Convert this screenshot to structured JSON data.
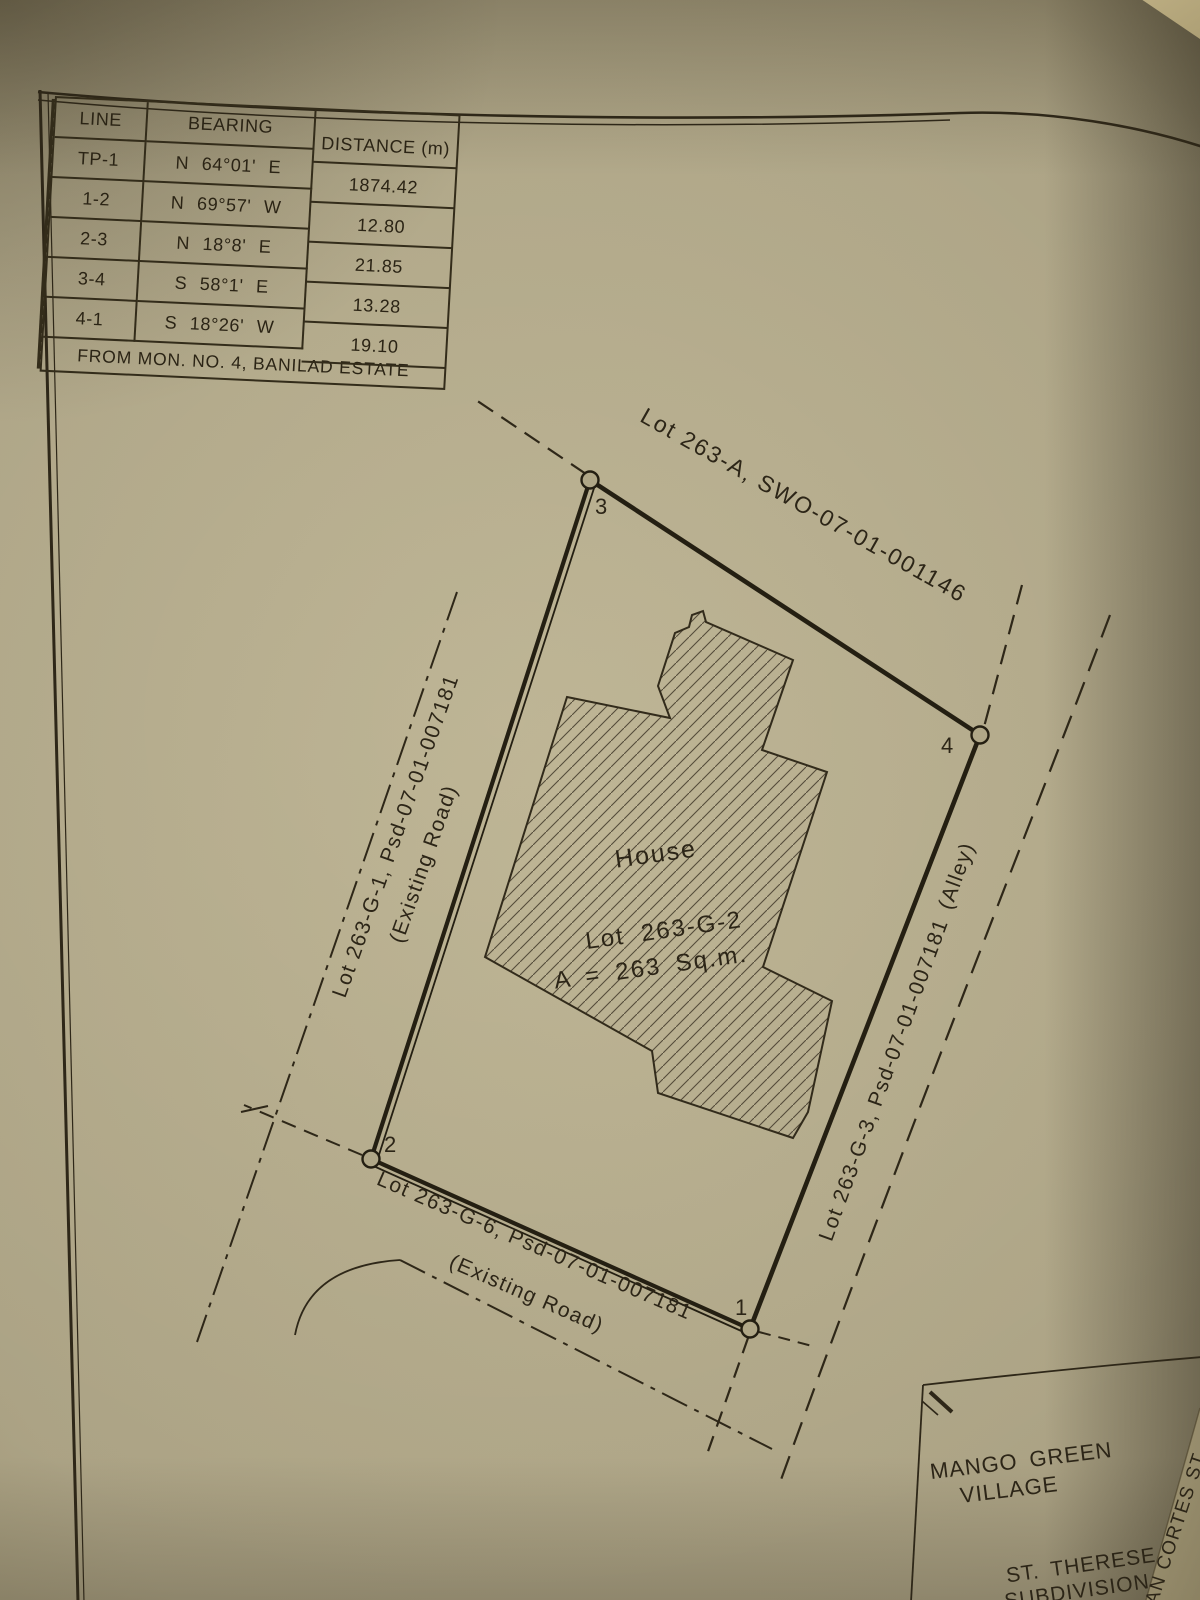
{
  "table": {
    "headers": {
      "line": "LINE",
      "bearing": "BEARING",
      "distance": "DISTANCE (m)"
    },
    "rows": [
      {
        "line": "TP-1",
        "bearing": "N 64°01' E",
        "distance": "1874.42"
      },
      {
        "line": "1-2",
        "bearing": "N 69°57' W",
        "distance": "12.80"
      },
      {
        "line": "2-3",
        "bearing": "N 18°8' E",
        "distance": "21.85"
      },
      {
        "line": "3-4",
        "bearing": "S 58°1' E",
        "distance": "13.28"
      },
      {
        "line": "4-1",
        "bearing": "S 18°26' W",
        "distance": "19.10"
      }
    ],
    "footer": "FROM MON. NO. 4, BANILAD ESTATE"
  },
  "plan": {
    "north_lot": "Lot 263-A, SWO-07-01-001146",
    "west_lot": "Lot 263-G-1, Psd-07-01-007181",
    "west_lot_note": "(Existing Road)",
    "east_lot": "Lot 263-G-3, Psd-07-01-007181",
    "east_lot_note": "(Alley)",
    "south_lot": "Lot 263-G-6, Psd-07-01-007181",
    "south_lot_note": "(Existing Road)",
    "house_label": "House",
    "lot_name": "Lot 263-G-2",
    "lot_area": "A = 263 Sq.m.",
    "corner_1": "1",
    "corner_2": "2",
    "corner_3": "3",
    "corner_4": "4",
    "village_line1": "MANGO GREEN",
    "village_line2": "VILLAGE",
    "subdivision_line1": "ST. THERESE",
    "subdivision_line2": "SUBDIVISION",
    "street": "AN CORTES ST."
  },
  "colors": {
    "paper": "#b3aa8a",
    "ink": "#2c2517"
  }
}
